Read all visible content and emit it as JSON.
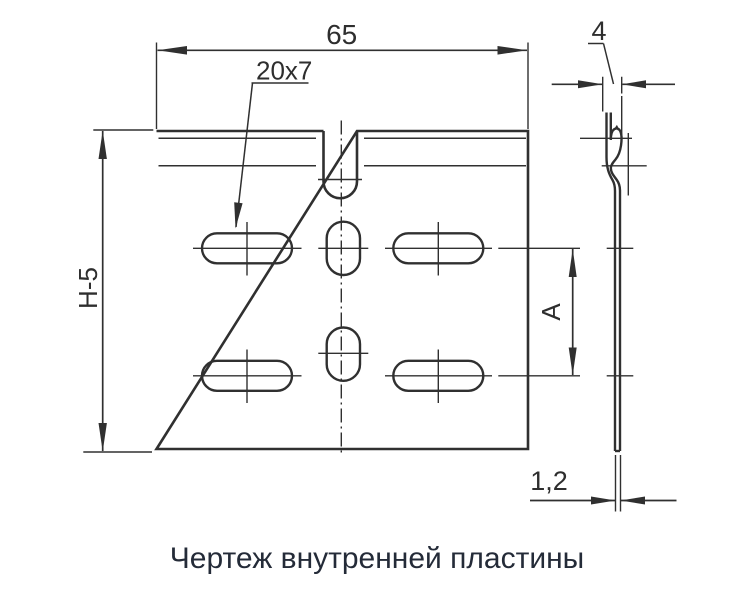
{
  "caption": "Чертеж внутренней пластины",
  "colors": {
    "line": "#303030",
    "dim_text": "#2e2e2e",
    "caption_text": "#242b38",
    "background": "#ffffff"
  },
  "front_view": {
    "width_dim": "65",
    "height_dim": "Н-5",
    "slot_size_dim": "20x7",
    "slot_pitch_dim": "А"
  },
  "side_view": {
    "rail_depth_dim": "4",
    "thickness_dim": "1,2"
  }
}
